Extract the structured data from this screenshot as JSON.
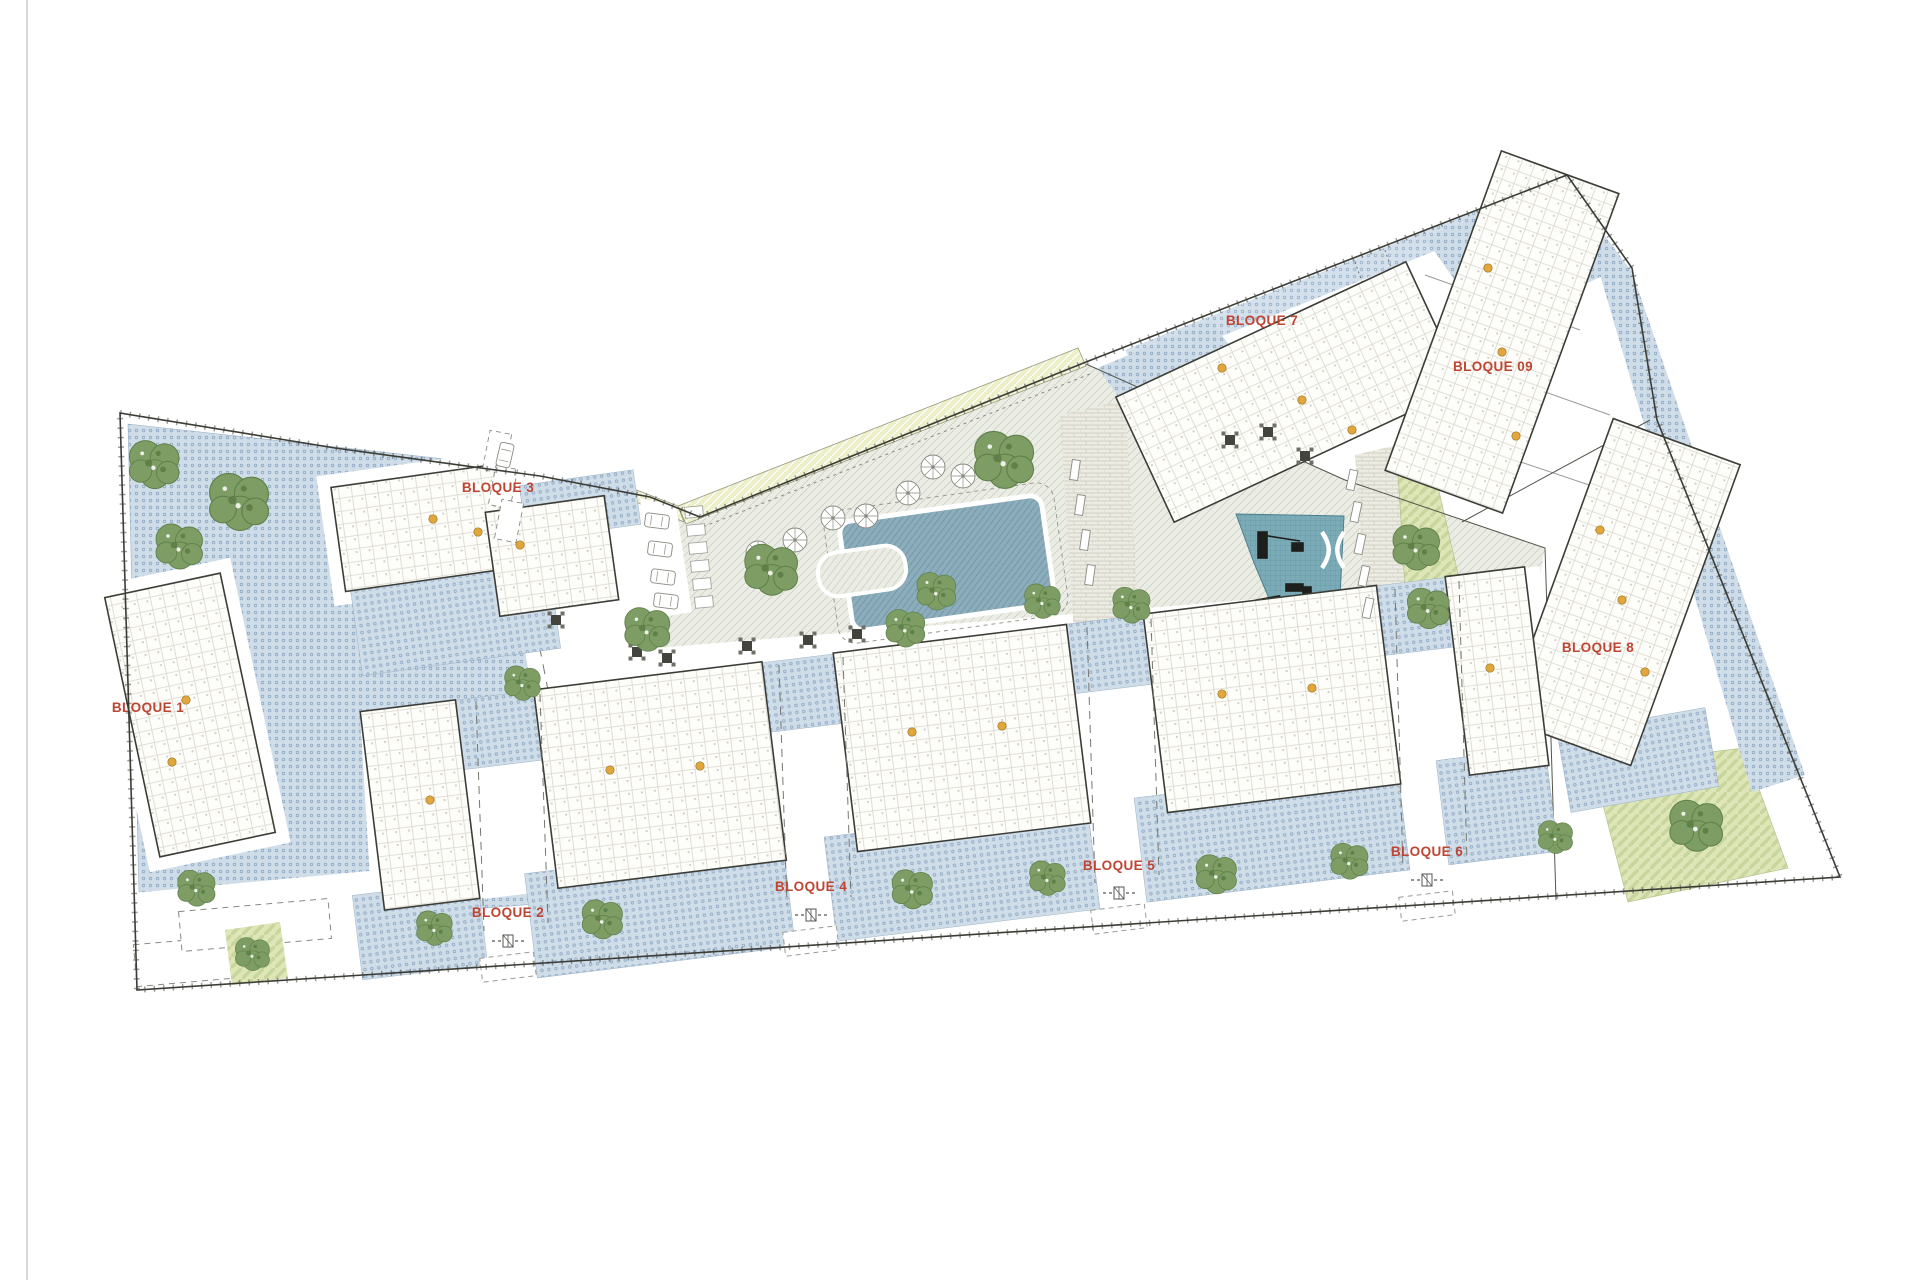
{
  "document": {
    "background": "#ffffff",
    "left_margin_line_color": "#cccccc"
  },
  "plan": {
    "type": "residential-complex-site-plan",
    "colors": {
      "label": "#bf4533",
      "outline": "#3c3c36",
      "fence": "#55554e",
      "terrace_fill": "#cfdde9",
      "terrace_dot": "#8fa9c4",
      "plaza_fill": "#ebede5",
      "plaza_line": "#c5ccc0",
      "pool_fill": "#8cadbb",
      "pool_line": "#7094a4",
      "playground_fill": "#7aabb6",
      "playground_line": "#5d8f9c",
      "lawn_fill": "#dee6b8",
      "lawn_stripe": "#c8d69e",
      "buffer_fill": "#edefc9",
      "tree_fill": "#7d9d64",
      "tree_dark": "#5f8049",
      "building_fill": "#fdfdf9",
      "building_line": "#3d3d38",
      "plan_texture_line": "#d9d6cd",
      "brick_fill": "#edece2",
      "brick_line": "#cbc9bd",
      "entry_dot": "#e2a63d",
      "road_mark": "#8a8a82"
    },
    "labels": [
      {
        "id": "bloque-1",
        "text": "BLOQUE 1",
        "x": 148,
        "y": 712
      },
      {
        "id": "bloque-2",
        "text": "BLOQUE 2",
        "x": 508,
        "y": 917
      },
      {
        "id": "bloque-3",
        "text": "BLOQUE 3",
        "x": 498,
        "y": 492
      },
      {
        "id": "bloque-4",
        "text": "BLOQUE 4",
        "x": 811,
        "y": 891
      },
      {
        "id": "bloque-5",
        "text": "BLOQUE 5",
        "x": 1119,
        "y": 870
      },
      {
        "id": "bloque-6",
        "text": "BLOQUE 6",
        "x": 1427,
        "y": 856
      },
      {
        "id": "bloque-7",
        "text": "BLOQUE 7",
        "x": 1262,
        "y": 325
      },
      {
        "id": "bloque-8",
        "text": "BLOQUE 8",
        "x": 1598,
        "y": 652
      },
      {
        "id": "bloque-09",
        "text": "BLOQUE 09",
        "x": 1493,
        "y": 371
      }
    ],
    "buildings": [
      {
        "id": "bloque-1",
        "cx": 190,
        "cy": 715,
        "w": 118,
        "h": 265,
        "rot": -12,
        "halo": true
      },
      {
        "id": "bloque-3a",
        "cx": 420,
        "cy": 528,
        "w": 165,
        "h": 105,
        "rot": -8,
        "halo": true
      },
      {
        "id": "bloque-3b",
        "cx": 552,
        "cy": 556,
        "w": 120,
        "h": 105,
        "rot": -8,
        "halo": true
      },
      {
        "id": "bloque-7",
        "cx": 1290,
        "cy": 392,
        "w": 320,
        "h": 138,
        "rot": -25,
        "halo": false
      },
      {
        "id": "bloque-09",
        "cx": 1502,
        "cy": 332,
        "w": 125,
        "h": 340,
        "rot": 20,
        "halo": false
      },
      {
        "id": "bloque-8",
        "cx": 1622,
        "cy": 592,
        "w": 135,
        "h": 320,
        "rot": 20,
        "halo": false
      },
      {
        "id": "band-1",
        "cx": 420,
        "cy": 805,
        "w": 96,
        "h": 200,
        "rot": -7,
        "halo": false
      },
      {
        "id": "band-2",
        "cx": 660,
        "cy": 775,
        "w": 230,
        "h": 200,
        "rot": -7,
        "halo": false
      },
      {
        "id": "band-3",
        "cx": 962,
        "cy": 738,
        "w": 235,
        "h": 200,
        "rot": -7,
        "halo": false
      },
      {
        "id": "band-4",
        "cx": 1272,
        "cy": 699,
        "w": 235,
        "h": 200,
        "rot": -7,
        "halo": false
      },
      {
        "id": "band-5",
        "cx": 1497,
        "cy": 671,
        "w": 80,
        "h": 200,
        "rot": -7,
        "halo": false
      }
    ],
    "terrace_patches": [
      {
        "cx": 580,
        "cy": 505,
        "w": 115,
        "h": 55,
        "rot": -8
      },
      {
        "cx": 455,
        "cy": 615,
        "w": 200,
        "h": 95,
        "rot": -8
      },
      {
        "cx": 420,
        "cy": 930,
        "w": 126,
        "h": 85,
        "rot": -7
      },
      {
        "cx": 660,
        "cy": 910,
        "w": 260,
        "h": 105,
        "rot": -7
      },
      {
        "cx": 962,
        "cy": 873,
        "w": 265,
        "h": 105,
        "rot": -7
      },
      {
        "cx": 1272,
        "cy": 834,
        "w": 265,
        "h": 105,
        "rot": -7
      },
      {
        "cx": 1497,
        "cy": 806,
        "w": 110,
        "h": 105,
        "rot": -7
      },
      {
        "cx": 508,
        "cy": 729,
        "w": 150,
        "h": 70,
        "rot": -7
      },
      {
        "cx": 811,
        "cy": 692,
        "w": 150,
        "h": 70,
        "rot": -7
      },
      {
        "cx": 1119,
        "cy": 653,
        "w": 150,
        "h": 70,
        "rot": -7
      },
      {
        "cx": 1427,
        "cy": 615,
        "w": 150,
        "h": 70,
        "rot": -7
      },
      {
        "cx": 1638,
        "cy": 760,
        "w": 150,
        "h": 80,
        "rot": -10
      }
    ],
    "trees": [
      {
        "x": 155,
        "y": 463,
        "s": 1.6
      },
      {
        "x": 240,
        "y": 500,
        "s": 1.9
      },
      {
        "x": 180,
        "y": 545,
        "s": 1.5
      },
      {
        "x": 197,
        "y": 887,
        "s": 1.2
      },
      {
        "x": 253,
        "y": 953,
        "s": 1.1
      },
      {
        "x": 1005,
        "y": 458,
        "s": 1.9
      },
      {
        "x": 772,
        "y": 568,
        "s": 1.7
      },
      {
        "x": 648,
        "y": 628,
        "s": 1.45
      },
      {
        "x": 937,
        "y": 590,
        "s": 1.25
      },
      {
        "x": 1043,
        "y": 600,
        "s": 1.15
      },
      {
        "x": 1417,
        "y": 546,
        "s": 1.5
      },
      {
        "x": 1429,
        "y": 607,
        "s": 1.35
      },
      {
        "x": 523,
        "y": 682,
        "s": 1.15
      },
      {
        "x": 906,
        "y": 627,
        "s": 1.25
      },
      {
        "x": 1132,
        "y": 604,
        "s": 1.2
      },
      {
        "x": 435,
        "y": 927,
        "s": 1.15
      },
      {
        "x": 603,
        "y": 918,
        "s": 1.3
      },
      {
        "x": 913,
        "y": 888,
        "s": 1.3
      },
      {
        "x": 1048,
        "y": 877,
        "s": 1.15
      },
      {
        "x": 1217,
        "y": 873,
        "s": 1.3
      },
      {
        "x": 1350,
        "y": 860,
        "s": 1.2
      },
      {
        "x": 1556,
        "y": 836,
        "s": 1.1
      },
      {
        "x": 1697,
        "y": 824,
        "s": 1.7
      }
    ],
    "parasols": [
      {
        "x": 833,
        "y": 518
      },
      {
        "x": 866,
        "y": 516
      },
      {
        "x": 908,
        "y": 493
      },
      {
        "x": 933,
        "y": 467
      },
      {
        "x": 963,
        "y": 476
      },
      {
        "x": 795,
        "y": 540
      },
      {
        "x": 758,
        "y": 553
      }
    ],
    "cars": [
      {
        "x": 657,
        "y": 521,
        "r": 97
      },
      {
        "x": 660,
        "y": 549,
        "r": 97
      },
      {
        "x": 663,
        "y": 577,
        "r": 97
      },
      {
        "x": 666,
        "y": 601,
        "r": 97
      },
      {
        "x": 505,
        "y": 455,
        "r": 13
      }
    ],
    "parking_stalls": [
      {
        "x": 497,
        "y": 452,
        "r": 101
      },
      {
        "x": 503,
        "y": 487,
        "r": 101
      },
      {
        "x": 509,
        "y": 521,
        "r": 101
      }
    ],
    "picnic_sets": [
      {
        "x": 637,
        "y": 652
      },
      {
        "x": 667,
        "y": 658
      },
      {
        "x": 747,
        "y": 646
      },
      {
        "x": 808,
        "y": 640
      },
      {
        "x": 857,
        "y": 634
      },
      {
        "x": 912,
        "y": 628
      },
      {
        "x": 1230,
        "y": 440
      },
      {
        "x": 1268,
        "y": 432
      },
      {
        "x": 1305,
        "y": 456
      },
      {
        "x": 556,
        "y": 620
      }
    ],
    "stepping_stones": [
      {
        "x": 694,
        "y": 512
      },
      {
        "x": 696,
        "y": 530
      },
      {
        "x": 698,
        "y": 548
      },
      {
        "x": 700,
        "y": 566
      },
      {
        "x": 702,
        "y": 584
      },
      {
        "x": 704,
        "y": 602
      }
    ],
    "benches": [
      {
        "x": 1352,
        "y": 480,
        "r": 12
      },
      {
        "x": 1356,
        "y": 512,
        "r": 12
      },
      {
        "x": 1360,
        "y": 544,
        "r": 12
      },
      {
        "x": 1364,
        "y": 576,
        "r": 12
      },
      {
        "x": 1368,
        "y": 608,
        "r": 12
      },
      {
        "x": 1075,
        "y": 470,
        "r": 8
      },
      {
        "x": 1080,
        "y": 505,
        "r": 8
      },
      {
        "x": 1085,
        "y": 540,
        "r": 8
      },
      {
        "x": 1090,
        "y": 575,
        "r": 8
      }
    ],
    "entry_dots": [
      {
        "x": 186,
        "y": 700
      },
      {
        "x": 172,
        "y": 762
      },
      {
        "x": 433,
        "y": 519
      },
      {
        "x": 478,
        "y": 532
      },
      {
        "x": 520,
        "y": 545
      },
      {
        "x": 610,
        "y": 770
      },
      {
        "x": 700,
        "y": 766
      },
      {
        "x": 912,
        "y": 732
      },
      {
        "x": 1002,
        "y": 726
      },
      {
        "x": 1222,
        "y": 694
      },
      {
        "x": 1312,
        "y": 688
      },
      {
        "x": 1490,
        "y": 668
      },
      {
        "x": 430,
        "y": 800
      },
      {
        "x": 1222,
        "y": 368
      },
      {
        "x": 1302,
        "y": 400
      },
      {
        "x": 1352,
        "y": 430
      },
      {
        "x": 1488,
        "y": 268
      },
      {
        "x": 1502,
        "y": 352
      },
      {
        "x": 1516,
        "y": 436
      },
      {
        "x": 1600,
        "y": 530
      },
      {
        "x": 1622,
        "y": 600
      },
      {
        "x": 1645,
        "y": 672
      }
    ],
    "corridors": [
      {
        "x": 508,
        "top": 702,
        "bottom": 931,
        "icon_y": 941
      },
      {
        "x": 811,
        "top": 665,
        "bottom": 905,
        "icon_y": 915
      },
      {
        "x": 1119,
        "top": 627,
        "bottom": 883,
        "icon_y": 893
      },
      {
        "x": 1427,
        "top": 589,
        "bottom": 870,
        "icon_y": 880
      }
    ]
  }
}
